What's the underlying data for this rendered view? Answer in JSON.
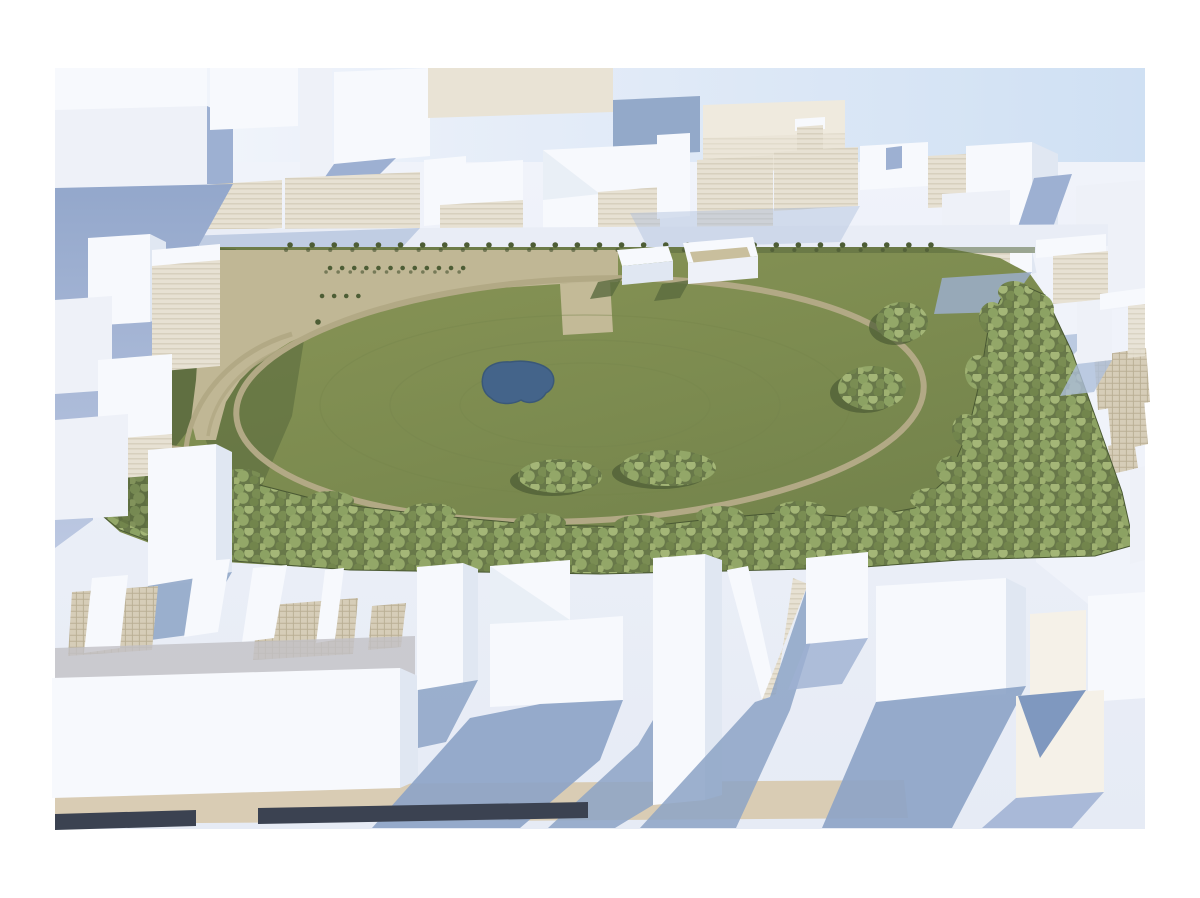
{
  "meta": {
    "description": "Aerial 3D architectural massing render: a large rectangular urban park with an oval loop path, small pond, tan entry plaza with tree rows, and dense perimeter tree belts, surrounded on all sides by white block massing buildings casting blue shadows",
    "image_type": "3d-render",
    "camera": "high oblique aerial, sun from upper right"
  },
  "colors": {
    "canvas": "#ffffff",
    "sky_left": "#f6f8fc",
    "sky_right": "#cfe0f3",
    "ground_top": "#f0f3fa",
    "ground_bottom": "#e6ebf5",
    "street_band": "#e9edf6",
    "street_grad_top": "#93a7cb",
    "street_grad_bottom": "#bcc8e2",
    "shadow_strong": "#8ca3c6",
    "shadow_medium": "#9db0d2",
    "shadow_soft": "#aebfdb",
    "shadow_triangle_blue": "#7f98bf",
    "building_top": "#f7f9fd",
    "building_face": "#eef1f8",
    "building_side": "#e0e7f2",
    "building_warm": "#f5f1e8",
    "wall_warm": "#e9e3d5",
    "slab_warm": "#efeade",
    "block_blue": "#93a9c9",
    "stripe_face": "#e7e1d3",
    "stripe_line": "#cdc5b1",
    "grid_face": "#d6cdb8",
    "grid_line": "#b9ae93",
    "grass_light": "#8a9557",
    "grass_mid": "#7d8c50",
    "grass_dark": "#70804a",
    "grass_shadow": "#5a6a3e",
    "grass_shadow_deep": "#4c5b34",
    "contour_line": "#75854c",
    "plaza_tan": "#c0b795",
    "path_tan": "#b2a985",
    "court_tan": "#c3ba97",
    "pond_fill": "#44648a",
    "pond_edge": "#3a5878",
    "canopy_base": "#687849",
    "canopy_light": "#a4b677",
    "canopy_light2": "#9fb171",
    "canopy_mid": "#8ca263",
    "canopy_mid2": "#93a768",
    "canopy_dark": "#7a8d53",
    "canopy_deep": "#72854c",
    "tree_row": "#4d5d35",
    "tree_row_shadow": "#445230",
    "pavilion_roof_tan": "#c9bf9d",
    "curb_white": "#ffffff",
    "band_tan": "#d9ccb4",
    "strip_dark": "#3b4251",
    "shade_band": "#c2c0c6"
  },
  "scene": {
    "regions": [
      {
        "name": "central-park",
        "features": [
          "oval-loop-path",
          "pond",
          "entry-plaza",
          "plaza-tree-rows",
          "perimeter-tree-row",
          "forest-belt",
          "lawn-tree-clusters",
          "two-pavilions",
          "west-loop-path",
          "sports-court-patch"
        ]
      },
      {
        "name": "north-building-district"
      },
      {
        "name": "west-building-district"
      },
      {
        "name": "east-building-district"
      },
      {
        "name": "south-foreground-district",
        "features": [
          "v-shaped-building",
          "tall-tower",
          "large-slab-roof",
          "terraced-grid-roofs",
          "tan-street-band",
          "dark-curb-strip"
        ]
      }
    ],
    "counts": {
      "perimeter_tree_row_spacing_px": 22,
      "plaza_tree_row1": 13,
      "plaza_tree_row2": 5,
      "pavilions": 2,
      "parking_hatch_patches": 3
    }
  }
}
